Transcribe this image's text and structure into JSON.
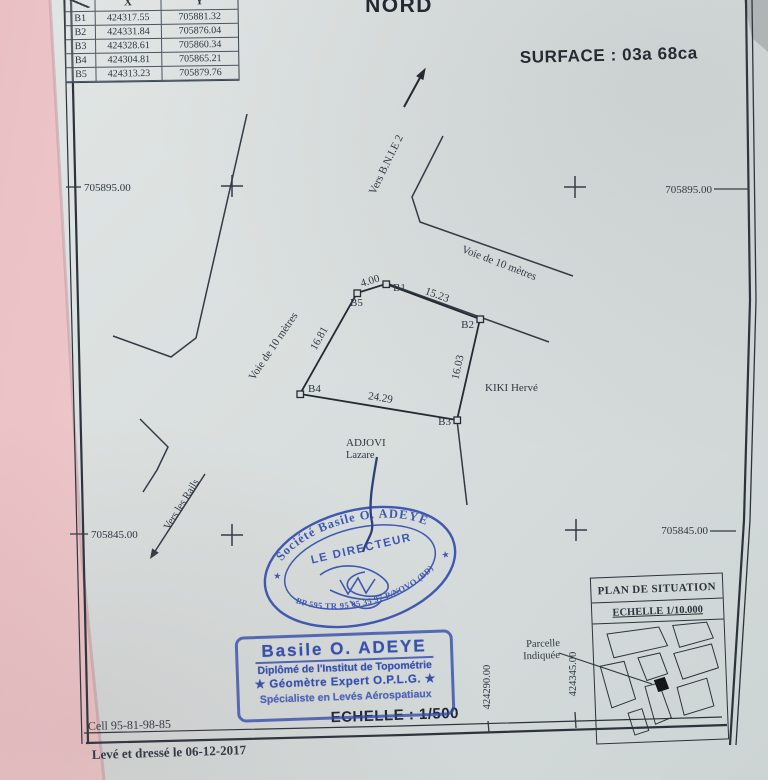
{
  "colors": {
    "ink": "#2e3742",
    "stamp_blue": "#2b46ad",
    "paper": "#d8dddc",
    "background_pink": "#eec5c8"
  },
  "header": {
    "north": "NORD",
    "surface": "SURFACE : 03a 68ca"
  },
  "coord_table": {
    "col_x": "X",
    "col_y": "Y",
    "rows": [
      {
        "point": "B1",
        "x": "424317.55",
        "y": "705881.32"
      },
      {
        "point": "B2",
        "x": "424331.84",
        "y": "705876.04"
      },
      {
        "point": "B3",
        "x": "424328.61",
        "y": "705860.34"
      },
      {
        "point": "B4",
        "x": "424304.81",
        "y": "705865.21"
      },
      {
        "point": "B5",
        "x": "424313.23",
        "y": "705879.76"
      }
    ]
  },
  "grid": {
    "y_top": "705895.00",
    "y_bottom": "705845.00",
    "x_left_tick": "424290.00",
    "x_right_tick": "424345.00"
  },
  "parcel": {
    "points": {
      "b1": "B1",
      "b2": "B2",
      "b3": "B3",
      "b4": "B4",
      "b5": "B5"
    },
    "distances": {
      "b5_b1": "4.00",
      "b1_b2": "15.23",
      "b2_b3": "16.03",
      "b4_b3": "24.29",
      "b4_b5": "16.81"
    },
    "neighbor_right": "KIKI Hervé",
    "neighbor_bottom_line1": "ADJOVI",
    "neighbor_bottom_line2": "Lazare"
  },
  "roads": {
    "voie_10m": "Voie de 10 mètres",
    "to_bnie": "Vers B.N.I.E 2",
    "to_rails": "Vers les Rails"
  },
  "round_stamp": {
    "arc_top": "Société Basile O. ADEYE",
    "arc_bottom": "BP 595 TR 95 05 35 97 P/NOVO (BD)",
    "center": "LE DIRECTEUR",
    "star": "★"
  },
  "surveyor_stamp": {
    "name": "Basile O. ADEYE",
    "line1": "Diplômé de l'Institut de Topométrie",
    "line2": "★ Géomètre Expert O.P.L.G. ★",
    "line3": "Spécialiste en Levés Aérospatiaux"
  },
  "scale": {
    "label": "ECHELLE : 1/500"
  },
  "situation_map": {
    "title": "PLAN DE SITUATION",
    "scale": "ECHELLE 1/10.000",
    "pointer_line1": "Parcelle",
    "pointer_line2": "Indiquée"
  },
  "footer": {
    "phone": "Cell 95-81-98-85",
    "date_note": "Levé et dressé le 06-12-2017"
  }
}
